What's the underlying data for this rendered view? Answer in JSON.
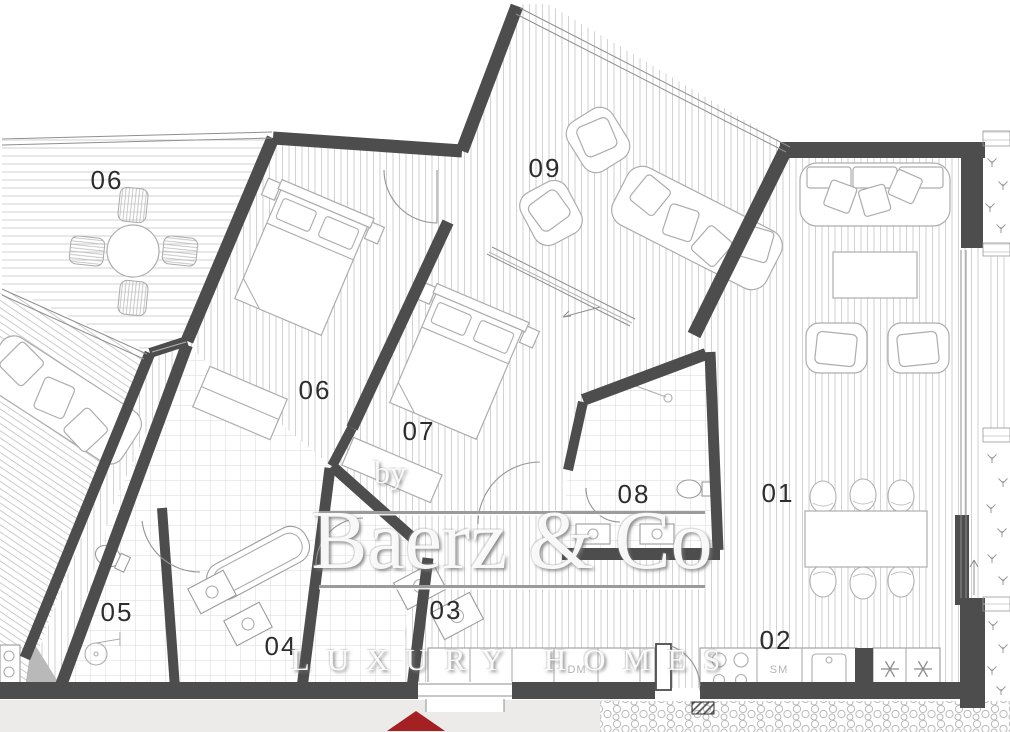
{
  "watermark": {
    "prefix": "by",
    "brand": "Baerz & Co",
    "tagline": "LUXURY HOMES"
  },
  "rooms": [
    {
      "id": "upper-terrace",
      "label": "06"
    },
    {
      "id": "terrace",
      "label": "09"
    },
    {
      "id": "bedroom-a",
      "label": "06"
    },
    {
      "id": "bedroom-b",
      "label": "07"
    },
    {
      "id": "bathroom-main",
      "label": "08"
    },
    {
      "id": "living-dining",
      "label": "01"
    },
    {
      "id": "kitchen",
      "label": "02"
    },
    {
      "id": "hallway",
      "label": "03"
    },
    {
      "id": "bathroom-a",
      "label": "04"
    },
    {
      "id": "bathroom-b",
      "label": "05"
    }
  ],
  "kitchen_labels": {
    "sm": "SM",
    "dm": "DM"
  },
  "colors": {
    "wall": "#4d4d4d",
    "floor_hatch": "#cdcdcd",
    "tile_line": "#dadada",
    "furniture_line": "#adadad",
    "room_label": "#2d2d2d",
    "entrance_arrow_red": "#a32023",
    "watermark": "#fcfcfc",
    "watermark_shadow": "#8f8f8f",
    "bottom_band": "#ecebe9"
  }
}
